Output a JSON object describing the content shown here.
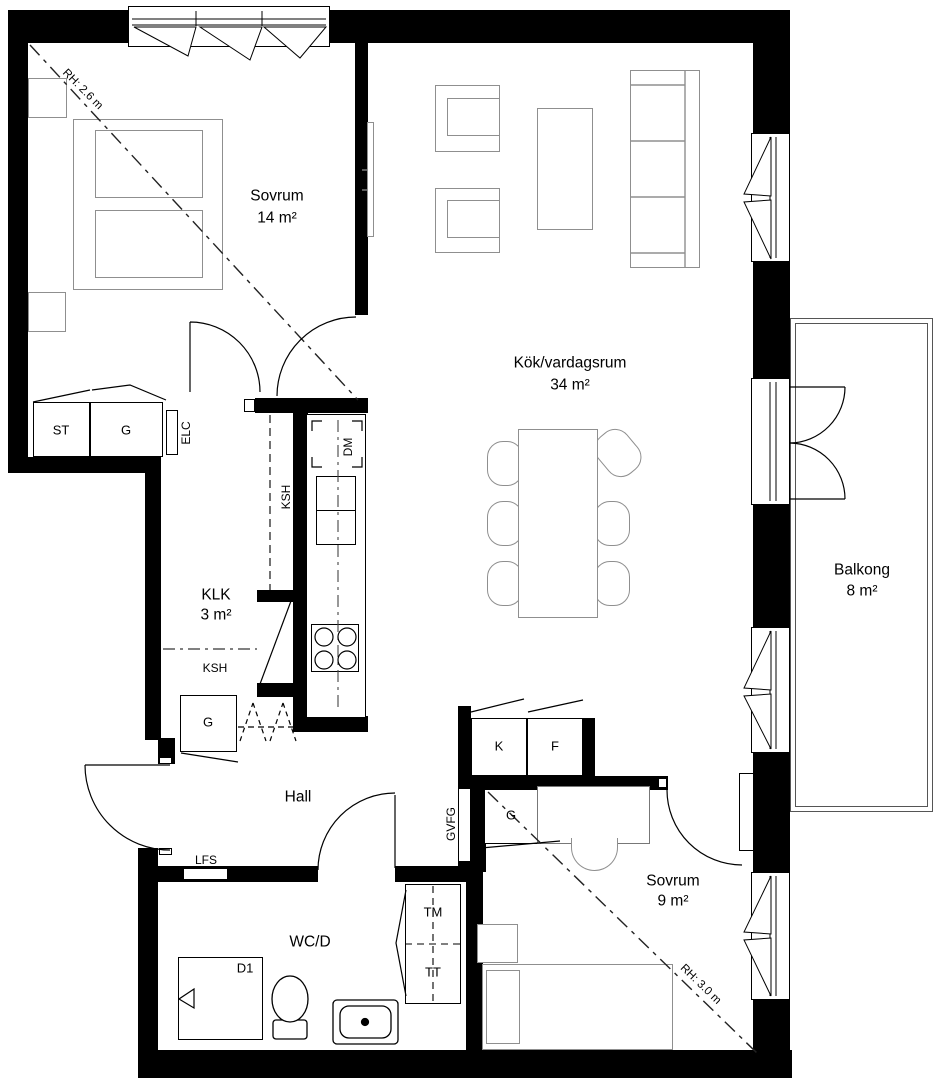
{
  "colors": {
    "wall": "#000000",
    "furniture": "#8f8f8f",
    "background": "#ffffff"
  },
  "rooms": {
    "bedroom1": {
      "name": "Sovrum",
      "area": "14 m²",
      "ceiling_height": "RH: 2.6 m"
    },
    "kitchen_living": {
      "name": "Kök/vardagsrum",
      "area": "34 m²"
    },
    "walk_in_closet": {
      "name": "KLK",
      "area": "3 m²"
    },
    "balcony": {
      "name": "Balkong",
      "area": "8 m²"
    },
    "hall": {
      "name": "Hall"
    },
    "bathroom": {
      "name": "WC/D"
    },
    "bedroom2": {
      "name": "Sovrum",
      "area": "9 m²",
      "ceiling_height": "RH: 3.0 m"
    }
  },
  "fixtures": {
    "st": "ST",
    "g_bedroom1": "G",
    "elc": "ELC",
    "ksh_upper": "KSH",
    "dm": "DM",
    "ksh_lower": "KSH",
    "g_hall": "G",
    "k": "K",
    "f": "F",
    "g_bedroom2": "G",
    "gvfg": "GVFG",
    "lfs": "LFS",
    "tm": "TM",
    "tt": "TT",
    "d1": "D1"
  }
}
